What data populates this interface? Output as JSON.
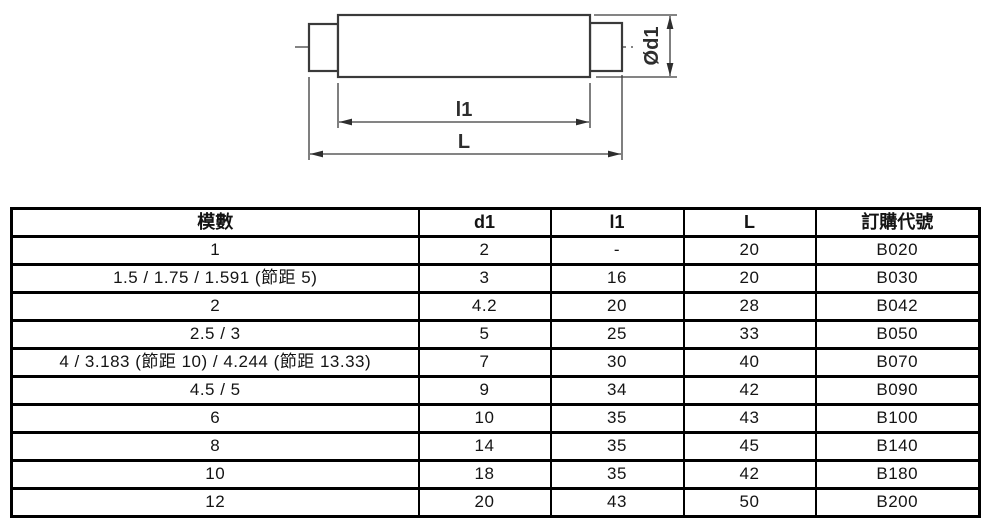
{
  "colors": {
    "background": "#ffffff",
    "table_border": "#000000",
    "drawing_line": "#3a3a3a",
    "text": "#141414"
  },
  "drawing": {
    "description": "side view of a cylindrical shaft blank with two smaller end journals, center line, and dimension callouts",
    "labels": {
      "l1": "l1",
      "L": "L",
      "d1": "Ød1"
    }
  },
  "table": {
    "header_keys": [
      "module",
      "d1",
      "l1",
      "L",
      "order-code"
    ],
    "headers": [
      "模數",
      "d1",
      "l1",
      "L",
      "訂購代號"
    ],
    "rows": [
      [
        "1",
        "2",
        "-",
        "20",
        "B020"
      ],
      [
        "1.5  /  1.75  /  1.591 (節距 5)",
        "3",
        "16",
        "20",
        "B030"
      ],
      [
        "2",
        "4.2",
        "20",
        "28",
        "B042"
      ],
      [
        "2.5  /  3",
        "5",
        "25",
        "33",
        "B050"
      ],
      [
        "4  /  3.183 (節距 10)  /  4.244 (節距 13.33)",
        "7",
        "30",
        "40",
        "B070"
      ],
      [
        "4.5  /  5",
        "9",
        "34",
        "42",
        "B090"
      ],
      [
        "6",
        "10",
        "35",
        "43",
        "B100"
      ],
      [
        "8",
        "14",
        "35",
        "45",
        "B140"
      ],
      [
        "10",
        "18",
        "35",
        "42",
        "B180"
      ],
      [
        "12",
        "20",
        "43",
        "50",
        "B200"
      ]
    ]
  }
}
